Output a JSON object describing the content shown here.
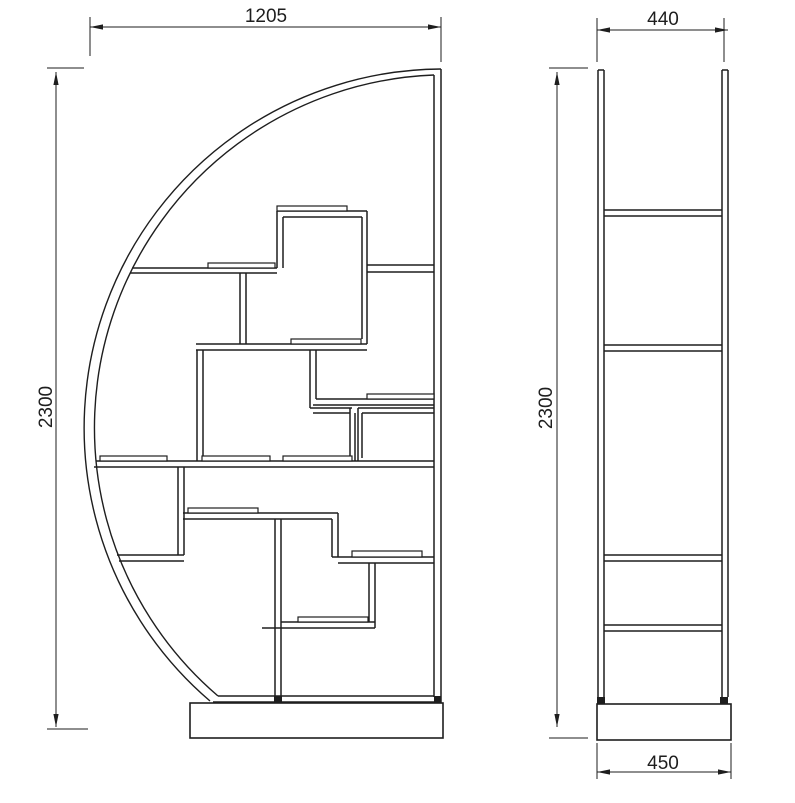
{
  "drawing": {
    "description": "Technical drawing of half-moon bookshelf, front and side views",
    "canvas": {
      "width": 795,
      "height": 803,
      "background": "#ffffff",
      "line_color": "#1e1e1e"
    },
    "front_view": {
      "lines": [
        [
          441,
          69,
          441,
          703
        ],
        [
          434,
          75,
          434,
          697
        ],
        [
          277,
          211,
          367,
          211
        ],
        [
          277,
          211,
          277,
          268
        ],
        [
          367,
          211,
          367,
          344
        ],
        [
          283,
          217,
          362,
          217
        ],
        [
          283,
          217,
          283,
          268
        ],
        [
          362,
          217,
          362,
          339
        ],
        [
          132,
          268,
          277,
          268
        ],
        [
          130,
          273,
          277,
          273
        ],
        [
          367,
          265,
          434,
          265
        ],
        [
          367,
          272,
          434,
          272
        ],
        [
          240,
          273,
          240,
          344
        ],
        [
          246,
          273,
          246,
          344
        ],
        [
          196,
          344,
          367,
          344
        ],
        [
          196,
          350,
          367,
          350
        ],
        [
          197,
          350,
          197,
          461
        ],
        [
          203,
          350,
          203,
          461
        ],
        [
          310,
          350,
          310,
          408
        ],
        [
          316,
          350,
          316,
          399
        ],
        [
          316,
          399,
          434,
          399
        ],
        [
          313,
          405,
          434,
          405
        ],
        [
          310,
          408,
          352,
          408
        ],
        [
          313,
          413,
          350,
          413
        ],
        [
          350,
          408,
          350,
          461
        ],
        [
          355,
          413,
          355,
          461
        ],
        [
          358,
          408,
          434,
          408
        ],
        [
          362,
          413,
          434,
          413
        ],
        [
          358,
          408,
          358,
          461
        ],
        [
          362,
          413,
          362,
          458
        ],
        [
          96,
          461,
          434,
          461
        ],
        [
          94,
          467,
          434,
          467
        ],
        [
          178,
          467,
          178,
          555
        ],
        [
          184,
          467,
          184,
          555
        ],
        [
          117,
          555,
          184,
          555
        ],
        [
          119,
          561,
          184,
          561
        ],
        [
          183,
          513,
          338,
          513
        ],
        [
          183,
          519,
          332,
          519
        ],
        [
          332,
          519,
          332,
          557
        ],
        [
          338,
          513,
          338,
          557
        ],
        [
          332,
          557,
          434,
          557
        ],
        [
          338,
          563,
          434,
          563
        ],
        [
          275,
          519,
          275,
          696
        ],
        [
          281,
          519,
          281,
          696
        ],
        [
          369,
          563,
          369,
          622
        ],
        [
          375,
          563,
          375,
          628
        ],
        [
          281,
          622,
          375,
          622
        ],
        [
          262,
          628,
          375,
          628
        ],
        [
          218,
          696,
          434,
          696
        ],
        [
          213,
          702,
          441,
          702
        ]
      ],
      "arcs": [
        {
          "x1": 441,
          "y1": 69,
          "r": 359,
          "x2": 210,
          "y2": 701
        },
        {
          "x1": 434,
          "y1": 75,
          "r": 353,
          "x2": 218,
          "y2": 696
        }
      ],
      "ledges": [
        [
          277,
          206,
          70,
          5
        ],
        [
          208,
          263,
          67,
          5
        ],
        [
          291,
          339,
          70,
          5
        ],
        [
          367,
          394,
          67,
          5
        ],
        [
          100,
          456,
          67,
          5
        ],
        [
          202,
          456,
          68,
          5
        ],
        [
          283,
          456,
          69,
          5
        ],
        [
          188,
          508,
          70,
          5
        ],
        [
          352,
          551,
          70,
          6
        ],
        [
          298,
          617,
          70,
          5
        ]
      ],
      "feet": [
        [
          274,
          696,
          8,
          7
        ],
        [
          434,
          696,
          7,
          7
        ]
      ],
      "base": [
        190,
        703,
        253,
        35
      ]
    },
    "side_view": {
      "lines": [
        [
          598,
          70,
          598,
          697
        ],
        [
          604,
          70,
          604,
          697
        ],
        [
          722,
          70,
          722,
          697
        ],
        [
          728,
          70,
          728,
          697
        ],
        [
          598,
          70,
          604,
          70
        ],
        [
          722,
          70,
          728,
          70
        ],
        [
          604,
          210,
          722,
          210
        ],
        [
          604,
          216,
          722,
          216
        ],
        [
          604,
          345,
          722,
          345
        ],
        [
          604,
          351,
          722,
          351
        ],
        [
          604,
          555,
          722,
          555
        ],
        [
          604,
          561,
          722,
          561
        ],
        [
          604,
          625,
          722,
          625
        ],
        [
          604,
          631,
          722,
          631
        ]
      ],
      "arcs": [],
      "ledges": [],
      "feet": [
        [
          597,
          697,
          8,
          7
        ],
        [
          720,
          697,
          8,
          7
        ]
      ],
      "base": [
        597,
        704,
        134,
        36
      ]
    },
    "dimensions": [
      {
        "name": "front-width",
        "label": "1205",
        "rotated": false,
        "text_pos": [
          266,
          22
        ],
        "line": [
          90,
          27,
          441,
          27
        ],
        "ext": [
          [
            90,
            17,
            90,
            56
          ],
          [
            441,
            17,
            441,
            62
          ]
        ],
        "arrows": [
          {
            "tip": [
              90,
              27
            ],
            "dir": "left"
          },
          {
            "tip": [
              441,
              27
            ],
            "dir": "right"
          }
        ]
      },
      {
        "name": "front-height",
        "label": "2300",
        "rotated": true,
        "text_pos": [
          52,
          407
        ],
        "line": [
          56,
          72,
          56,
          727
        ],
        "ext": [
          [
            47,
            68,
            84,
            68
          ],
          [
            47,
            729,
            88,
            729
          ]
        ],
        "arrows": [
          {
            "tip": [
              56,
              72
            ],
            "dir": "up"
          },
          {
            "tip": [
              56,
              727
            ],
            "dir": "down"
          }
        ]
      },
      {
        "name": "side-width",
        "label": "440",
        "rotated": false,
        "text_pos": [
          663,
          25
        ],
        "line": [
          597,
          30,
          728,
          30
        ],
        "ext": [
          [
            597,
            18,
            597,
            62
          ],
          [
            724,
            18,
            724,
            62
          ]
        ],
        "arrows": [
          {
            "tip": [
              597,
              30
            ],
            "dir": "left"
          },
          {
            "tip": [
              728,
              30
            ],
            "dir": "right"
          }
        ]
      },
      {
        "name": "side-height",
        "label": "2300",
        "rotated": true,
        "text_pos": [
          552,
          408
        ],
        "line": [
          557,
          72,
          557,
          727
        ],
        "ext": [
          [
            549,
            68,
            588,
            68
          ],
          [
            549,
            738,
            588,
            738
          ]
        ],
        "arrows": [
          {
            "tip": [
              557,
              72
            ],
            "dir": "up"
          },
          {
            "tip": [
              557,
              727
            ],
            "dir": "down"
          }
        ]
      },
      {
        "name": "side-base-width",
        "label": "450",
        "rotated": false,
        "text_pos": [
          663,
          769
        ],
        "line": [
          597,
          772,
          731,
          772
        ],
        "ext": [
          [
            597,
            743,
            597,
            779
          ],
          [
            731,
            743,
            731,
            779
          ]
        ],
        "arrows": [
          {
            "tip": [
              597,
              772
            ],
            "dir": "left"
          },
          {
            "tip": [
              731,
              772
            ],
            "dir": "right"
          }
        ]
      }
    ]
  }
}
